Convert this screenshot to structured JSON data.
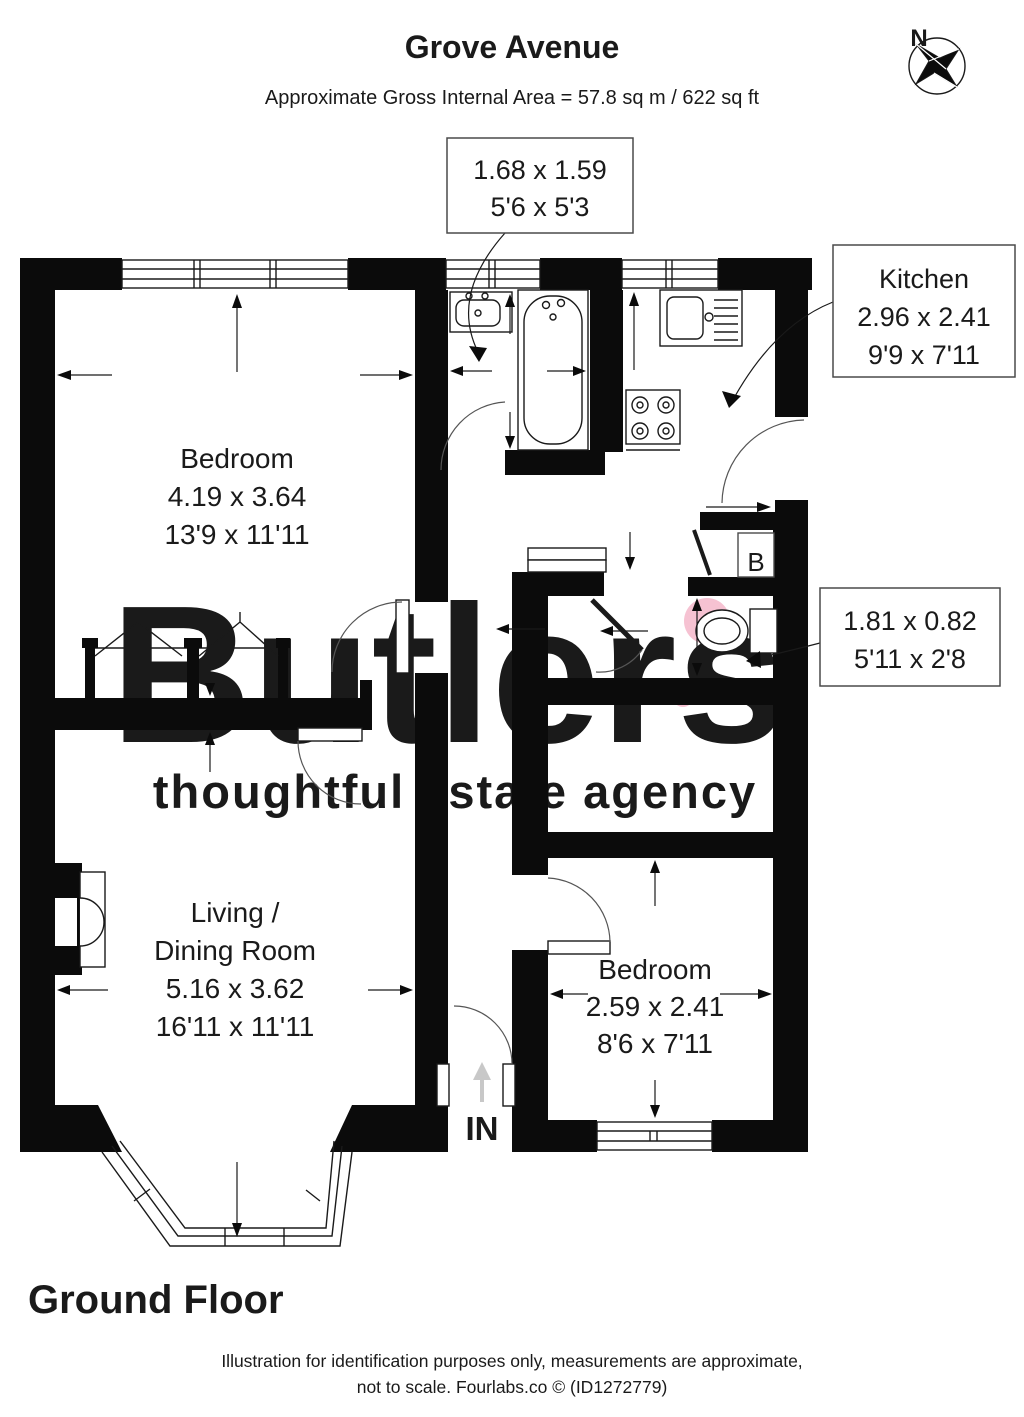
{
  "header": {
    "title": "Grove Avenue",
    "subtitle": "Approximate Gross Internal Area = 57.8 sq m / 622 sq ft"
  },
  "compass": {
    "north_label": "N"
  },
  "plan": {
    "rooms": {
      "bedroom1": {
        "name": "Bedroom",
        "metric": "4.19 x 3.64",
        "imperial": "13'9 x 11'11"
      },
      "living": {
        "name_line1": "Living /",
        "name_line2": "Dining Room",
        "metric": "5.16 x 3.62",
        "imperial": "16'11 x 11'11"
      },
      "bedroom2": {
        "name": "Bedroom",
        "metric": "2.59 x 2.41",
        "imperial": "8'6 x 7'11"
      },
      "kitchen": {
        "name": "Kitchen",
        "metric": "2.96 x 2.41",
        "imperial": "9'9 x 7'11"
      },
      "bathroom": {
        "metric": "1.68 x 1.59",
        "imperial": "5'6 x 5'3"
      },
      "wc": {
        "metric": "1.81 x 0.82",
        "imperial": "5'11 x 2'8"
      }
    },
    "boiler_label": "B",
    "entrance_label": "IN"
  },
  "floor_title": "Ground Floor",
  "watermark": {
    "brand": "Butlers",
    "tagline": "thoughtful estate agency",
    "brand_color": "#d4d4d4",
    "accent_color": "#f4bfce"
  },
  "footer": {
    "line1": "Illustration for identification purposes only, measurements are approximate,",
    "line2": "not to scale. Fourlabs.co © (ID1272779)"
  }
}
